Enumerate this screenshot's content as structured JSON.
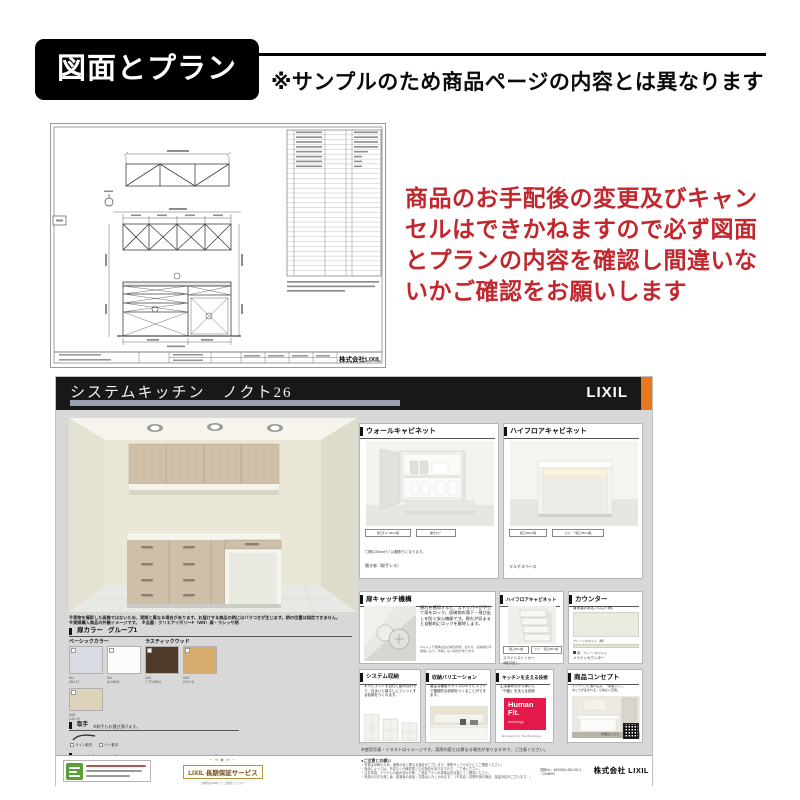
{
  "top": {
    "banner_label": "図面とプラン",
    "note": "※サンプルのため商品ページの内容とは異なります"
  },
  "warning": {
    "color": "#c1272d",
    "lines": [
      "商品のお手配後の変更及びキャン",
      "セルはできかねますので必ず図面",
      "とプランの内容を確認し間違いな",
      "いかご確認をお願いします"
    ]
  },
  "drawing": {
    "company": "株式会社LIXIL"
  },
  "sheet": {
    "header": {
      "title": "システムキッチン　ノクト26",
      "brand": "LIXIL",
      "bg_color": "#181818",
      "accent_color": "#e8781e"
    },
    "render_notes": [
      "※実物を撮影した画像ではないため、実際と異なる場合があります。お届けする商品の柄にはバラつきが生じます。柄の位置は指定できません。",
      "※実際購入商品の外観イメージです。　※品番：クリエアイボリーF（WN）扉・ラシッサ柄"
    ],
    "door_color": {
      "title": "扉カラー",
      "group": "グループ1",
      "category1": "ベーシックカラー",
      "category2": "ラスティックウッド",
      "swatches": [
        {
          "color": "#d9dbe2",
          "code": "W4",
          "name": "(W4-T)"
        },
        {
          "color": "#fcfcfa",
          "code": "W4",
          "name": "(A-NW3)"
        },
        {
          "color": "#4e3a28",
          "code": "LW1",
          "name": "ﾌﾞﾗｳﾝ(9B4)"
        },
        {
          "color": "#d7ab6b",
          "code": "LW2",
          "name": "(10L+1)"
        }
      ],
      "extra_swatch": {
        "color": "#ddd2ba",
        "code": "LW3",
        "name": "(10L+2)"
      }
    },
    "handle": {
      "title": "取手",
      "note": "※取手もお選び頂けます。",
      "options": [
        "ライン取手",
        "バー取手"
      ]
    },
    "worktop": {
      "title": "ワークトップ",
      "chip": "選択"
    },
    "sink": {
      "title": "シンク",
      "chip": "選択"
    },
    "panels": {
      "wall_cabinet": {
        "title": "ウォールキャビネット",
        "chip1": "間口ｻｲｽﾞ45cm幅",
        "chip2": "開きﾀｲﾌﾟ",
        "note1": "〇間口45cmﾀｲﾌﾟは棚割りになります。",
        "note2": "開き扉（取手レス）"
      },
      "highfloor_open": {
        "title": "ハイフロアキャビネット",
        "chip1": "間口45cm幅",
        "chip2": "ｽﾗｲﾄﾞ・間口45cm幅",
        "note": "マルチスペース"
      },
      "door_catch": {
        "title": "扉キャッチ機構",
        "body": "揺れを感知すると、ストッパーが下りて扉をロック。収納物の落下・飛び出しを防ぐ安心機能です。揺れが収まると自動的にロックを解除します。",
        "footnote": "※キャッチ機構は扉の開閉状態、揺れ方、収納物の状態等により、作動しない場合があります。"
      },
      "highfloor_drawer": {
        "title": "ハイフロアキャビネット",
        "chip1": "間口45cm幅",
        "chip2": "ｽﾗｲﾄﾞ・間口45cm幅",
        "note1": "スライドストッカー",
        "note2": "4段引出し"
      },
      "counter": {
        "title": "カウンター",
        "lead": "清潔感のあるフロスト柄。",
        "name": "プレーンホワイト（柄）",
        "sub": "柄：プレーンホワイト",
        "material": "メラミンカウンター"
      },
      "system_storage": {
        "title": "システム収納",
        "body": "キャビネットを自在に組み合わせて、住まいと暮らしにフィットする収納をつくれます。"
      },
      "storage_variation": {
        "title": "収納バリエーション",
        "body": "豊富な棚板やサイズのキャビネットで機能的な収納をつくることができます。"
      },
      "technology": {
        "title": "キッチンを支える技術",
        "body1": "生活者研究から導いた",
        "body2": "「行動」を支える技術",
        "logo1": "Human",
        "logo2": "Fit.",
        "logo3": "technology",
        "logo_color": "#e5194a",
        "caption": "Human Fit Technology"
      },
      "concept": {
        "title": "商品コンセプト",
        "body1": "インテリアに溶け込み、「家事らく」、",
        "body2": "ゆとりが生まれる、心地よい空間。",
        "qr_caption": "詳細はこちら"
      }
    },
    "footnote": "※使用写真・イラストはイメージです。実際内容とは異なる場合がありますので、ご注意ください。",
    "footer": {
      "warranty": {
        "ornament": "─≪◆≫─",
        "title": "LIXIL 長期保証サービス",
        "sub": "詳細はWEBにてご確認ください"
      },
      "notice_title": "●ご注意とお願い",
      "notice_lines": [
        "・写真は印刷のため、実際の色と異なる場合がございます。実物サンプルなどにてご確認ください。",
        "・商品によっては、予告なく仕様変更となる場合がありますので、ご了承ください。",
        "・注意事項、アイテムの組み合わせ等、ご選定プランの詳細は担当者にてご確認ください。",
        "・商品のお引き渡し後・設置後の返品・交換はいたしかねます。（不具合・初期不良の場合、保証対応がございます。）"
      ],
      "estimate_no": "見積No：4800004-482-001-1",
      "estimate_sub": "（104890）",
      "company": "株式会社 LIXIL"
    }
  }
}
